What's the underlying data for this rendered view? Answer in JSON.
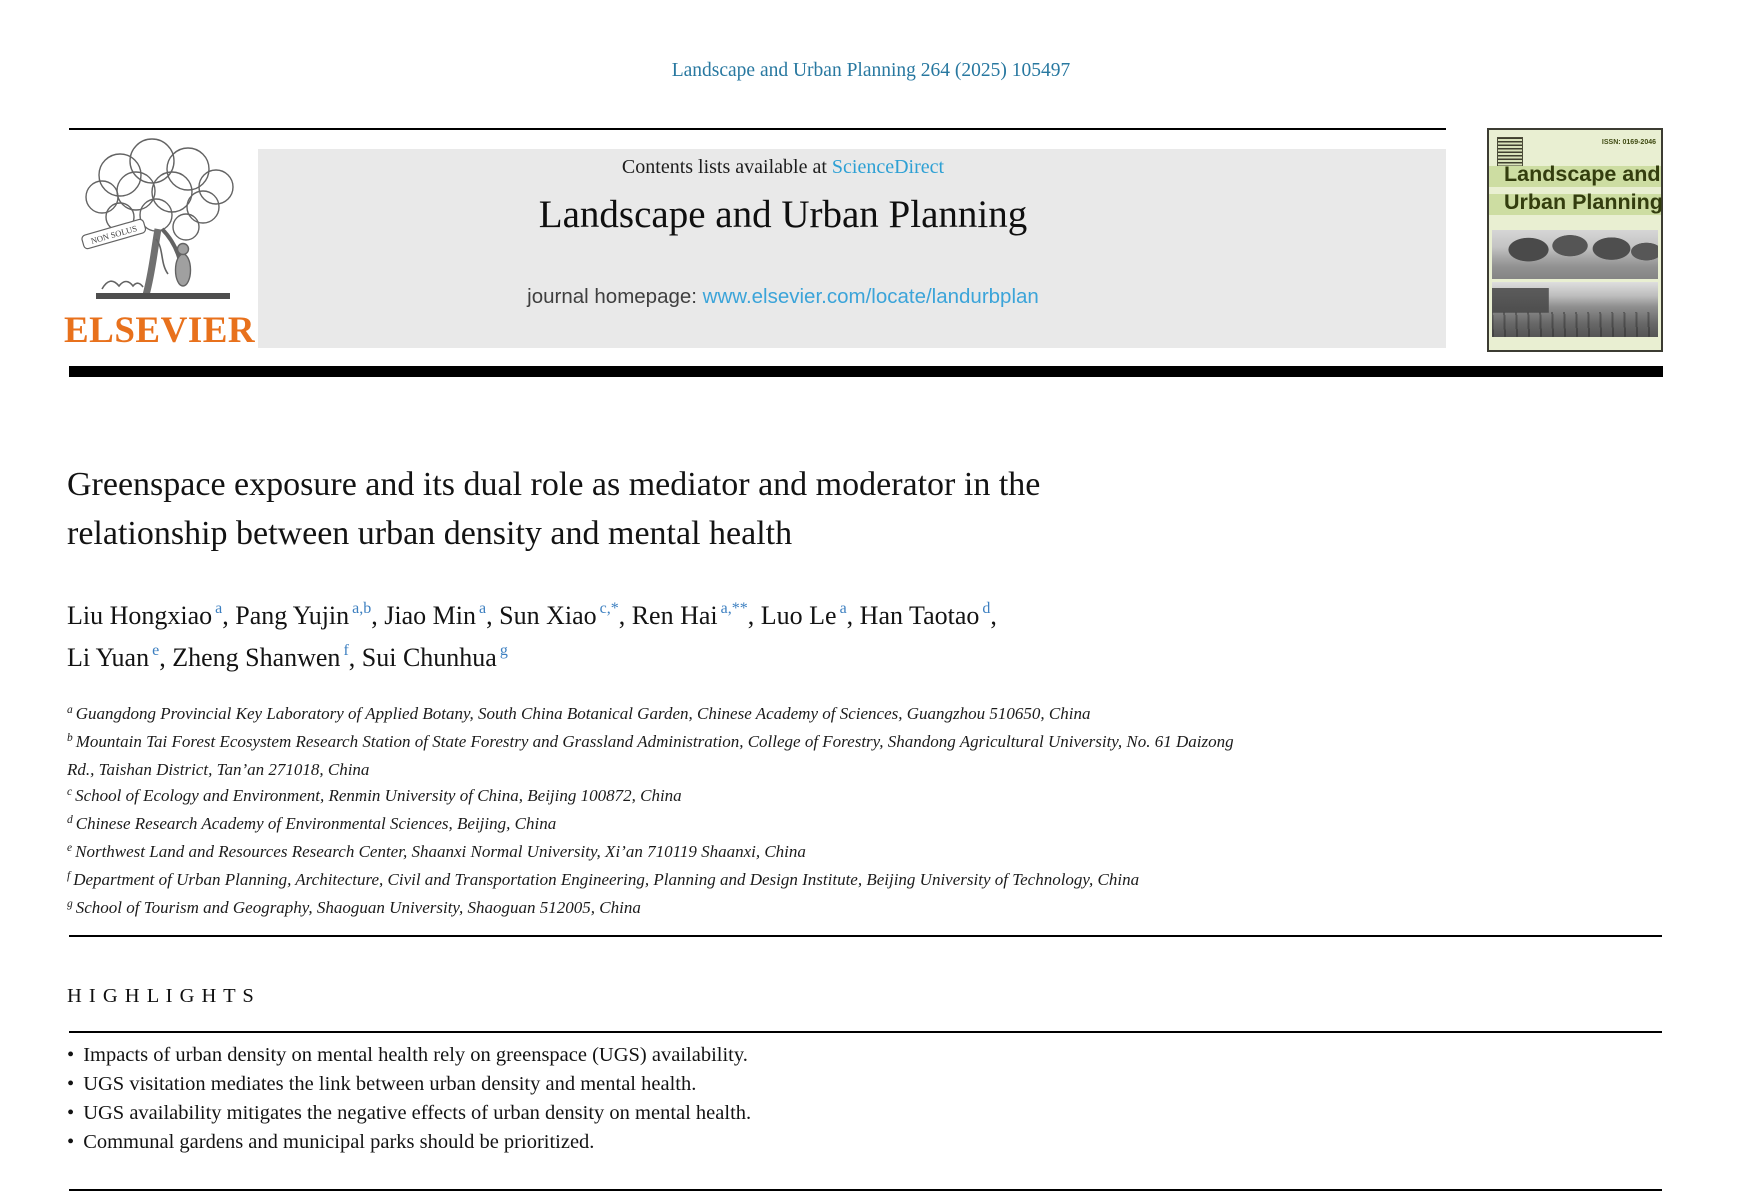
{
  "page": {
    "citation": "Landscape and Urban Planning 264 (2025) 105497"
  },
  "colors": {
    "citation_blue": "#2878a0",
    "link_blue": "#2da0d4",
    "homepage_link_blue": "#3ba4d9",
    "superscript_blue": "#3c7fc0",
    "elsevier_orange": "#e8711c",
    "header_gray": "#e9e9e9",
    "cover_background_green": "#e9efd2",
    "cover_band_green": "#cddda2",
    "cover_text_green": "#333d0e",
    "rule_black": "#000000"
  },
  "header": {
    "contents_prefix": "Contents lists available at ",
    "sciencedirect": "ScienceDirect",
    "journal_title": "Landscape and Urban Planning",
    "homepage_prefix": "journal homepage: ",
    "homepage_url": "www.elsevier.com/locate/landurbplan",
    "elsevier_wordmark": "ELSEVIER",
    "non_solus": "NON SOLUS"
  },
  "cover": {
    "issn": "ISSN: 0169-2046",
    "title_line1": "Landscape and",
    "title_line2": "Urban Planning"
  },
  "article": {
    "title_line1": "Greenspace exposure and its dual role as mediator and moderator in the",
    "title_line2": "relationship between urban density and mental health",
    "authors_line1": [
      {
        "name": "Liu Hongxiao",
        "sup": "a",
        "trail": ", "
      },
      {
        "name": "Pang Yujin",
        "sup": "a,b",
        "trail": ", "
      },
      {
        "name": "Jiao Min",
        "sup": "a",
        "trail": ", "
      },
      {
        "name": "Sun Xiao",
        "sup": "c,*",
        "trail": ", "
      },
      {
        "name": "Ren Hai",
        "sup": "a,**",
        "trail": ", "
      },
      {
        "name": "Luo Le",
        "sup": "a",
        "trail": ", "
      },
      {
        "name": "Han Taotao",
        "sup": "d",
        "trail": ","
      }
    ],
    "authors_line2": [
      {
        "name": "Li Yuan",
        "sup": "e",
        "trail": ", "
      },
      {
        "name": "Zheng Shanwen",
        "sup": "f",
        "trail": ", "
      },
      {
        "name": "Sui Chunhua",
        "sup": "g",
        "trail": ""
      }
    ],
    "affiliations": [
      {
        "label": "a",
        "lines": [
          "Guangdong Provincial Key Laboratory of Applied Botany, South China Botanical Garden, Chinese Academy of Sciences, Guangzhou 510650, China"
        ]
      },
      {
        "label": "b",
        "lines": [
          "Mountain Tai Forest Ecosystem Research Station of State Forestry and Grassland Administration, College of Forestry, Shandong Agricultural University, No. 61 Daizong",
          "Rd., Taishan District, Tan’an 271018, China"
        ]
      },
      {
        "label": "c",
        "lines": [
          "School of Ecology and Environment, Renmin University of China, Beijing 100872, China"
        ]
      },
      {
        "label": "d",
        "lines": [
          "Chinese Research Academy of Environmental Sciences, Beijing, China"
        ]
      },
      {
        "label": "e",
        "lines": [
          "Northwest Land and Resources Research Center, Shaanxi Normal University, Xi’an 710119 Shaanxi, China"
        ]
      },
      {
        "label": "f",
        "lines": [
          "Department of Urban Planning, Architecture, Civil and Transportation Engineering, Planning and Design Institute, Beijing University of Technology, China"
        ]
      },
      {
        "label": "g",
        "lines": [
          "School of Tourism and Geography, Shaoguan University, Shaoguan 512005, China"
        ]
      }
    ]
  },
  "highlights": {
    "heading": "H I G H L I G H T S",
    "items": [
      "Impacts of urban density on mental health rely on greenspace (UGS) availability.",
      "UGS visitation mediates the link between urban density and mental health.",
      "UGS availability mitigates the negative effects of urban density on mental health.",
      "Communal gardens and municipal parks should be prioritized."
    ]
  }
}
